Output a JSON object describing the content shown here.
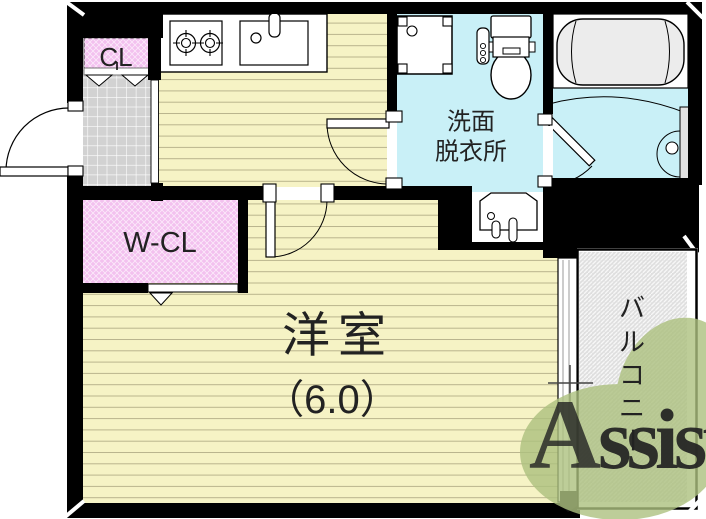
{
  "labels": {
    "closet": "CL",
    "walk_in_closet": "W-CL",
    "washroom_line1": "洗面",
    "washroom_line2": "脱衣所",
    "main_room": "洋室",
    "main_room_size": "（6.0）",
    "balcony_chars": [
      "バ",
      "ル",
      "コ",
      "ニ",
      "ー"
    ]
  },
  "watermark": {
    "initial": "A",
    "rest": "ssist"
  },
  "colors": {
    "wall": "#000000",
    "flooring": "#f6f3c5",
    "flooring_line": "#b9b48d",
    "water_room": "#c9f0f7",
    "closet_pink": "#f3c1ef",
    "entrance_tile": "#d2d2d2",
    "balcony_base": "#dedede",
    "bathtub": "#ececec",
    "watermark_green": "#adc17f",
    "watermark_initial": "#e09090",
    "watermark_text": "#fafafa"
  }
}
